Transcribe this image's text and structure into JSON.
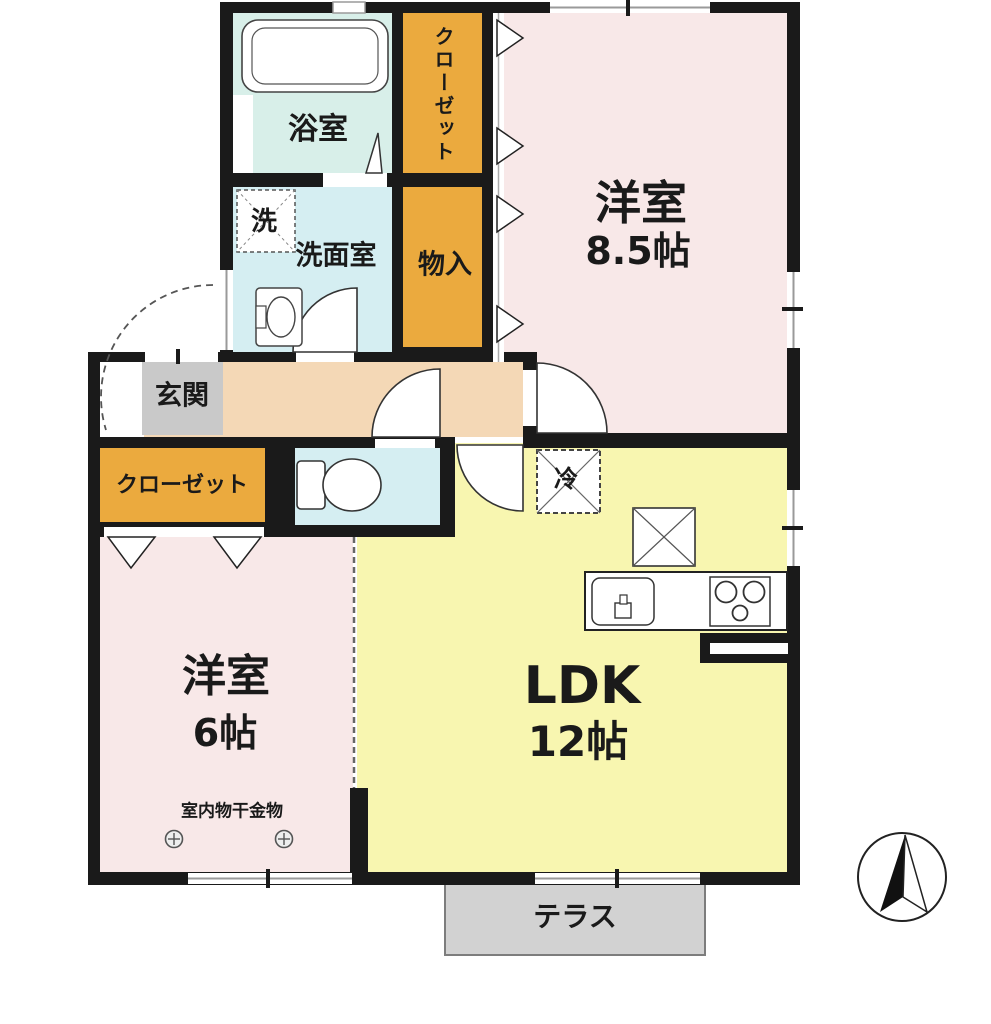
{
  "rooms": {
    "bedroom1": {
      "name": "洋室",
      "size": "8.5帖"
    },
    "bedroom2": {
      "name": "洋室",
      "size": "6帖"
    },
    "ldk": {
      "name": "LDK",
      "size": "12帖"
    },
    "bath": {
      "label": "浴室"
    },
    "washroom": {
      "label": "洗面室"
    },
    "washer": {
      "label": "洗"
    },
    "closet_upper": {
      "label": "クローゼット"
    },
    "storage": {
      "label": "物入"
    },
    "entrance": {
      "label": "玄関"
    },
    "closet_lower": {
      "label": "クローゼット"
    },
    "refrigerator": {
      "label": "冷"
    },
    "drying_fixture": {
      "label": "室内物干金物"
    },
    "terrace": {
      "label": "テラス"
    }
  },
  "colors": {
    "wall": "#1a1a1a",
    "western_room": "#f8e8e8",
    "ldk": "#f8f6b0",
    "wet_area": "#d5eef2",
    "bath": "#d8efe9",
    "corridor": "#f4d8b6",
    "closet": "#ebaa3e",
    "entrance_floor": "#c9c9c9",
    "terrace": "#d2d2d2"
  }
}
